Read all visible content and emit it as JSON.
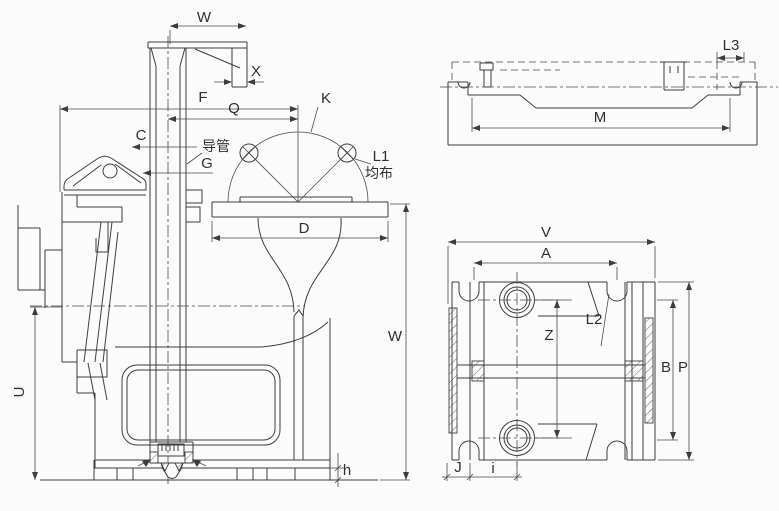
{
  "figure": {
    "kind": "engineering-drawing",
    "colors": {
      "line": "#3d3d3d",
      "background": "#fbfbfb",
      "text": "#2f2f2f"
    }
  },
  "labels": {
    "main": {
      "w_top": "W",
      "x": "X",
      "f": "F",
      "q": "Q",
      "c": "C",
      "guide_tube": "导管",
      "g": "G",
      "k": "K",
      "l1": "L1",
      "evenly_distributed": "均布",
      "d": "D",
      "w_right": "W",
      "u": "U",
      "h": "h"
    },
    "side": {
      "m": "M",
      "l3": "L3"
    },
    "plan": {
      "v": "V",
      "a": "A",
      "z": "Z",
      "l2": "L2",
      "b": "B",
      "p": "P",
      "j": "J",
      "i": "i"
    }
  }
}
